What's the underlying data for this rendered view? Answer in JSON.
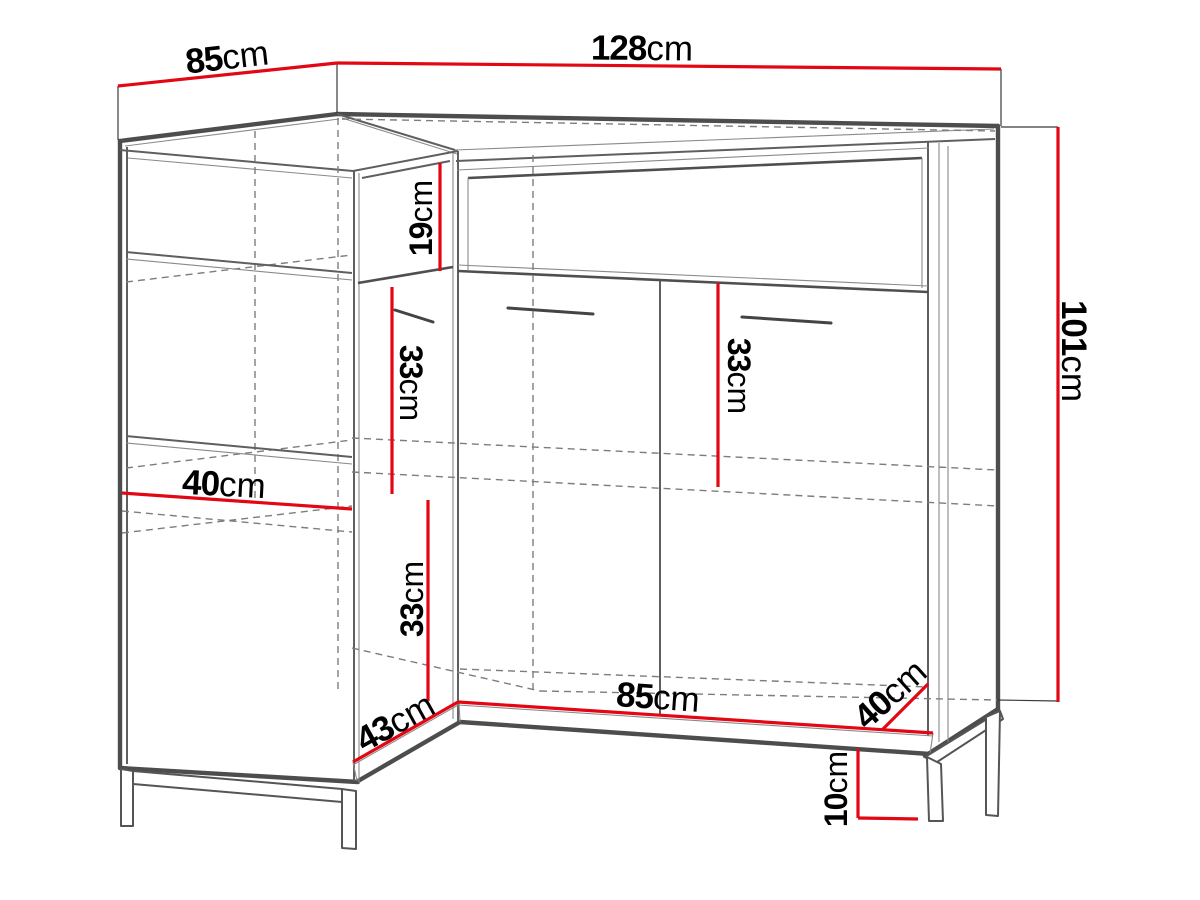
{
  "diagram": {
    "type": "furniture-dimension-drawing",
    "subject": "corner sideboard with legs, drawers and doors",
    "colors": {
      "background": "#ffffff",
      "dimension_red": "#e30613",
      "carcass_dark": "#4d4d4d",
      "carcass_mid": "#5f5f5f",
      "hidden_dashed": "#7d7d7d",
      "label_text": "#000000"
    },
    "dims": {
      "top_depth": {
        "value": "85",
        "unit": "cm"
      },
      "top_width": {
        "value": "128",
        "unit": "cm"
      },
      "height": {
        "value": "101",
        "unit": "cm"
      },
      "drawer_height": {
        "value": "19",
        "unit": "cm"
      },
      "left_door_upper": {
        "value": "33",
        "unit": "cm"
      },
      "right_door": {
        "value": "33",
        "unit": "cm"
      },
      "shelf_depth": {
        "value": "40",
        "unit": "cm"
      },
      "left_door_lower": {
        "value": "33",
        "unit": "cm"
      },
      "front_left_width": {
        "value": "43",
        "unit": "cm"
      },
      "front_right_width": {
        "value": "85",
        "unit": "cm"
      },
      "right_side_depth": {
        "value": "40",
        "unit": "cm"
      },
      "leg_height": {
        "value": "10",
        "unit": "cm"
      }
    }
  }
}
